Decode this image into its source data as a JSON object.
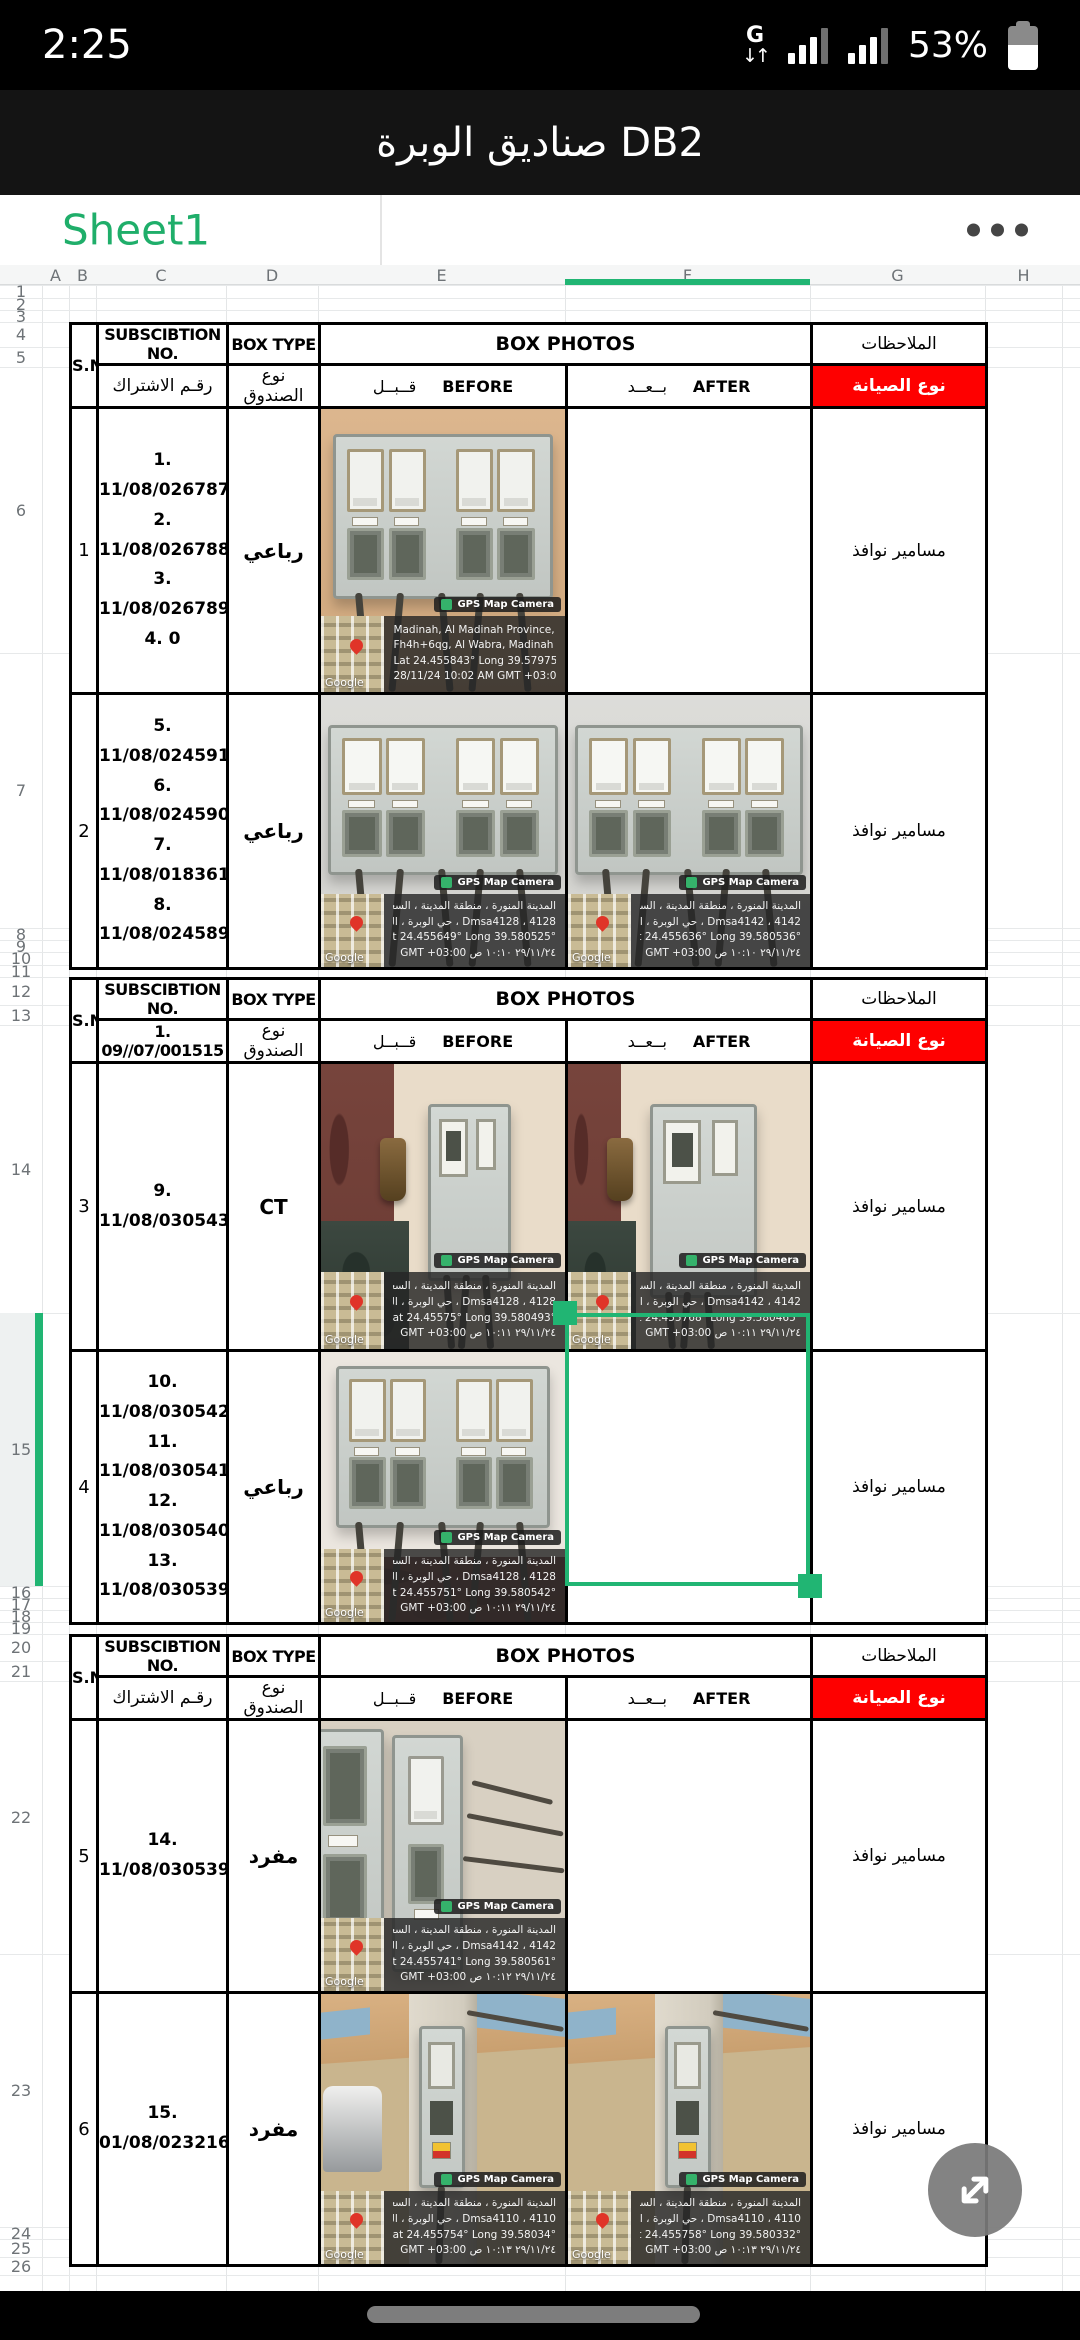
{
  "colors": {
    "accent_green": "#1fae6a",
    "selection_green": "#21b573",
    "header_red": "#fe0000"
  },
  "status_bar": {
    "time": "2:25",
    "battery_percent": "53%",
    "icons": [
      "mobile-data-g-icon",
      "signal-bars-icon",
      "signal-bars-icon",
      "battery-icon"
    ]
  },
  "title_bar": {
    "title": "DB2 صناديق الوبرة"
  },
  "tab_bar": {
    "sheet_name": "Sheet1",
    "menu_icon": "more-options"
  },
  "grid": {
    "column_labels": [
      "A",
      "B",
      "C",
      "D",
      "E",
      "F",
      "G",
      "H"
    ],
    "row_labels": [
      "1",
      "2",
      "3",
      "4",
      "5",
      "6",
      "7",
      "8",
      "9",
      "10",
      "11",
      "12",
      "13",
      "14",
      "15",
      "16",
      "17",
      "18",
      "19",
      "20",
      "21",
      "22",
      "23",
      "24",
      "25",
      "26"
    ],
    "selected_column": "F",
    "selected_row": "15",
    "selected_cell": "F15"
  },
  "table_labels": {
    "sn": "S.N",
    "subscription_no": "SUBSCIBTION NO.",
    "subscription_no_ar": "رقـم الاشتراك",
    "box_type": "BOX TYPE",
    "box_type_ar": "نوع الصندوق",
    "box_photos": "BOX PHOTOS",
    "before_ar": "قــبــل",
    "before_en": "BEFORE",
    "after_ar": "بــعــد",
    "after_en": "AFTER",
    "notes_ar": "الملاحظات",
    "maintenance_type_ar": "نوع الصيانة"
  },
  "watermark_labels": {
    "badge": "GPS Map Camera",
    "map_attribution": "Google"
  },
  "blocks": [
    {
      "header_row": "4",
      "subscription_header_override": null,
      "rows": [
        {
          "row": "6",
          "sn": "1",
          "subscriptions": [
            "1. 11/08/026787",
            "2. 11/08/026788",
            "3. 11/08/026789",
            "4. 0"
          ],
          "box_type": "رباعي",
          "note": "مسامير نوافذ",
          "before_photo": {
            "variant": "quad-beige",
            "watermark_lang": "en",
            "watermark": [
              "Madinah, Al Madinah Province, Saudi Arabia",
              "Fh4h+6qg, Al Wabra, Madinah 42371, Saudi Arabia",
              "Lat 24.455843° Long 39.579758°",
              "28/11/24 10:02 AM GMT +03:00"
            ]
          },
          "after_photo": null
        },
        {
          "row": "7",
          "sn": "2",
          "subscriptions": [
            "5. 11/08/024591",
            "6. 11/08/024590",
            "7. 11/08/018361",
            "8. 11/08/024589"
          ],
          "box_type": "رباعي",
          "note": "مسامير نوافذ",
          "before_photo": {
            "variant": "quad-gray",
            "watermark_lang": "ar",
            "watermark": [
              "المدينة المنورة ، منطقة المدينة ، السعودية",
              "Dmsa4128 ، 4128 ، حي الوبرة ، المدينة المنورة 42371 ، السعودية",
              "Lat 24.455649° Long 39.580525°",
              "٢٩/١١/٢٤ ١٠:١٠ ص GMT +03:00"
            ]
          },
          "after_photo": {
            "variant": "quad-gray",
            "watermark_lang": "ar",
            "watermark": [
              "المدينة المنورة ، منطقة المدينة ، السعودية",
              "Dmsa4142 ، 4142 ، حي الوبرة ، المدينة المنورة 42371 ، السعودية",
              "Lat 24.455636° Long 39.580536°",
              "٢٩/١١/٢٤ ١٠:١٠ ص GMT +03:00"
            ]
          }
        }
      ]
    },
    {
      "header_row": "12",
      "subscription_header_override": "1. 09//07/001515",
      "rows": [
        {
          "row": "14",
          "sn": "3",
          "subscriptions": [
            "9. 11/08/030543"
          ],
          "box_type": "CT",
          "note": "مسامير نوافذ",
          "before_photo": {
            "variant": "ct-before",
            "watermark_lang": "ar",
            "watermark": [
              "المدينة المنورة ، منطقة المدينة ، السعودية",
              "Dmsa4128 ، 4128 ، حي الوبرة ، المدينة المنورة 42371 ، السعودية",
              "Lat 24.45575° Long 39.580493°",
              "٢٩/١١/٢٤ ١٠:١١ ص GMT +03:00"
            ]
          },
          "after_photo": {
            "variant": "ct-after",
            "watermark_lang": "ar",
            "watermark": [
              "المدينة المنورة ، منطقة المدينة ، السعودية",
              "Dmsa4142 ، 4142 ، حي الوبرة ، المدينة المنورة 42371 ، السعودية",
              "Lat 24.455768° Long 39.580465°",
              "٢٩/١١/٢٤ ١٠:١١ ص GMT +03:00"
            ]
          }
        },
        {
          "row": "15",
          "sn": "4",
          "selected": true,
          "subscriptions": [
            "10. 11/08/030542",
            "11. 11/08/030541",
            "12. 11/08/030540",
            "13. 11/08/030539"
          ],
          "box_type": "رباعي",
          "note": "مسامير نوافذ",
          "before_photo": {
            "variant": "quad-marble",
            "watermark_lang": "ar",
            "watermark": [
              "المدينة المنورة ، منطقة المدينة ، السعودية",
              "Dmsa4128 ، 4128 ، حي الوبرة ، المدينة المنورة 42371 ، السعودية",
              "Lat 24.455751° Long 39.580542°",
              "٢٩/١١/٢٤ ١٠:١١ ص GMT +03:00"
            ]
          },
          "after_photo": null
        }
      ]
    },
    {
      "header_row": "20",
      "subscription_header_override": null,
      "rows": [
        {
          "row": "22",
          "sn": "5",
          "subscriptions": [
            "14. 11/08/030539"
          ],
          "box_type": "مفرد",
          "note": "مسامير نوافذ",
          "before_photo": {
            "variant": "single-pair",
            "watermark_lang": "ar",
            "watermark": [
              "المدينة المنورة ، منطقة المدينة ، السعودية",
              "Dmsa4142 ، 4142 ، حي الوبرة ، المدينة المنورة 42371 ، السعودية",
              "Lat 24.455741° Long 39.580561°",
              "٢٩/١١/٢٤ ١٠:١٢ ص GMT +03:00"
            ]
          },
          "after_photo": null
        },
        {
          "row": "23",
          "sn": "6",
          "subscriptions": [
            "15. 01/08/023216"
          ],
          "box_type": "مفرد",
          "note": "مسامير نوافذ",
          "before_photo": {
            "variant": "pillar-tank",
            "watermark_lang": "ar",
            "watermark": [
              "المدينة المنورة ، منطقة المدينة ، السعودية",
              "Dmsa4110 ، 4110 ، حي الوبرة ، المدينة المنورة 42371 ، السعودية",
              "Lat 24.455754° Long 39.58034°",
              "٢٩/١١/٢٤ ١٠:١٣ ص GMT +03:00"
            ]
          },
          "after_photo": {
            "variant": "pillar",
            "watermark_lang": "ar",
            "watermark": [
              "المدينة المنورة ، منطقة المدينة ، السعودية",
              "Dmsa4110 ، 4110 ، حي الوبرة ، المدينة المنورة 42371 ، السعودية",
              "Lat 24.455758° Long 39.580332°",
              "٢٩/١١/٢٤ ١٠:١٣ ص GMT +03:00"
            ]
          }
        }
      ]
    }
  ],
  "fab": {
    "icon": "expand-arrows"
  },
  "nav_bar": {
    "icon": "gesture-pill"
  }
}
